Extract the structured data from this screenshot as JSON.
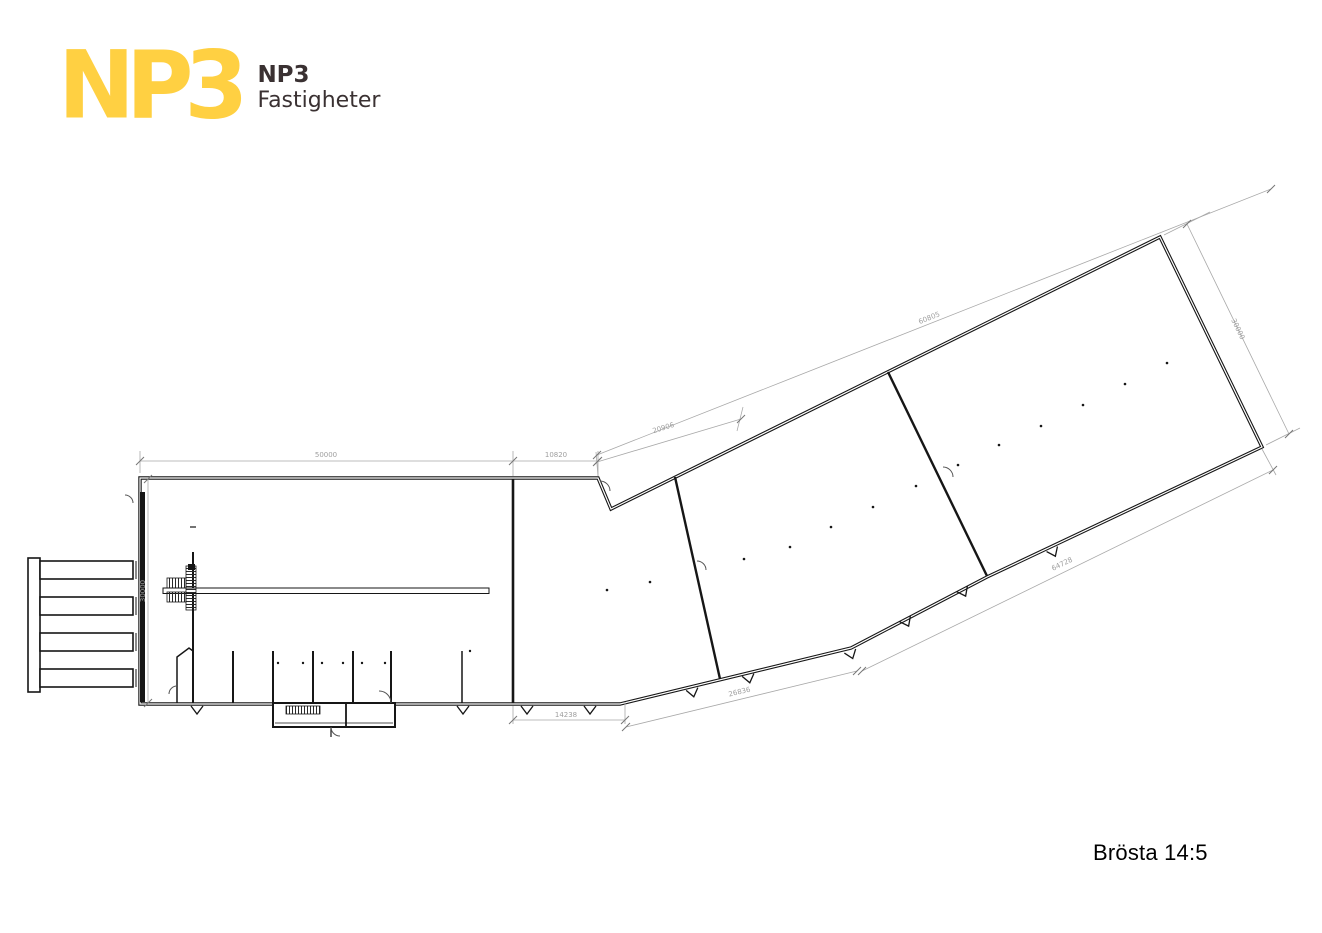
{
  "logo": {
    "mark": "NP3",
    "name_top": "NP3",
    "name_bottom": "Fastigheter",
    "yellow": "#FFD042",
    "dark": "#3A3132"
  },
  "plan": {
    "line_color": "#161616",
    "dim_color": "#9e9e9e",
    "dims": {
      "top_main": "50000",
      "top_ext": "10820",
      "left_height": "30000",
      "bottom_left": "14238",
      "bottom_mid": "26836",
      "bottom_right": "64728",
      "diag_seg": "20906",
      "diag_total": "60805",
      "right_height": "30000"
    }
  },
  "title": {
    "text": "Brösta 14:5"
  }
}
